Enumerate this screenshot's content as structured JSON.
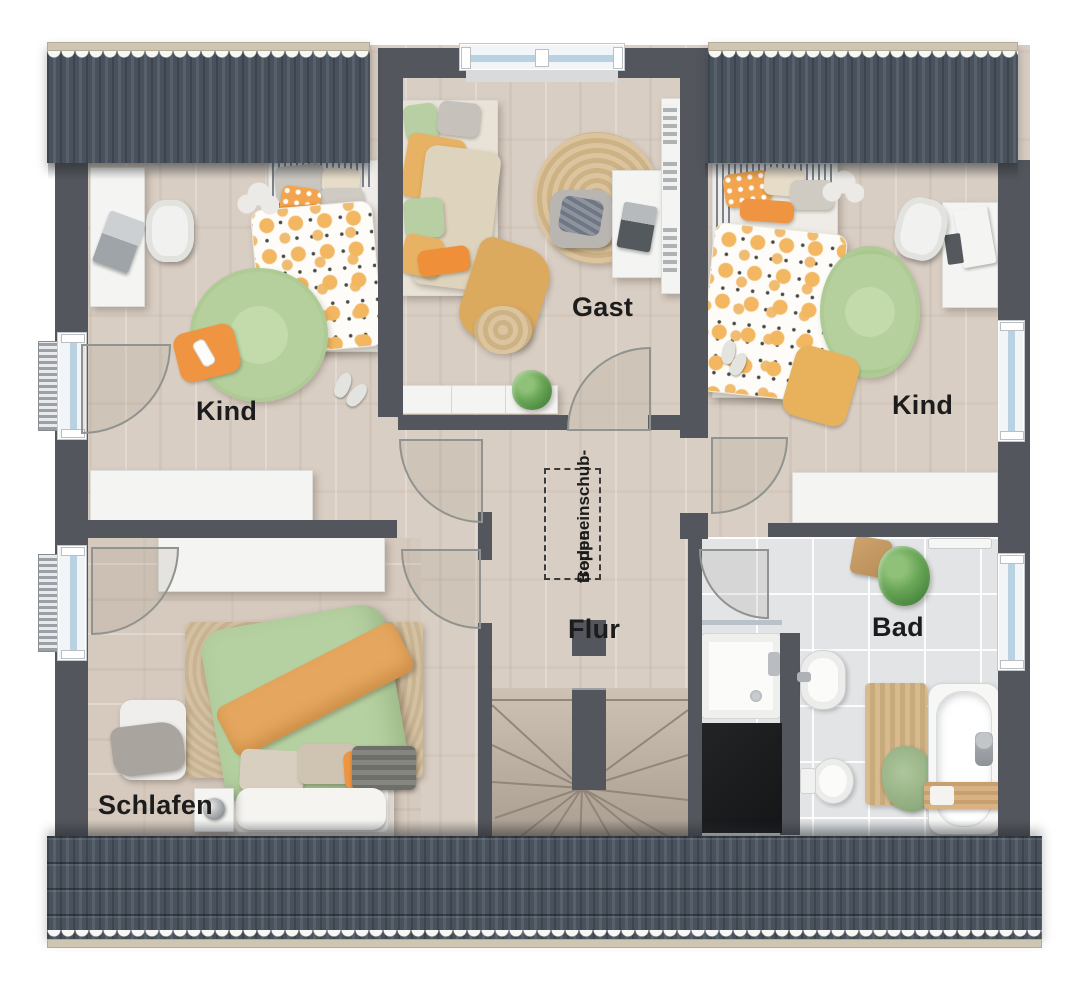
{
  "plan": {
    "kind": "attic-floor-plan"
  },
  "rooms": {
    "kind_left": {
      "label": "Kind"
    },
    "gast": {
      "label": "Gast"
    },
    "kind_right": {
      "label": "Kind"
    },
    "flur": {
      "label": "Flur"
    },
    "schlafen": {
      "label": "Schlafen"
    },
    "bad": {
      "label": "Bad"
    }
  },
  "annotations": {
    "attic_hatch_line1": "Bodeneinschub-",
    "attic_hatch_line2": "treppe"
  },
  "colors": {
    "wall": "#53565c",
    "roof": "#47505a",
    "wood_floor": "#d9cec3",
    "tile_floor": "#e2e4e6",
    "accent_orange": "#ef9440",
    "accent_green": "#b6d1a1",
    "accent_yellow": "#e8b25c",
    "furniture_white": "#f4f4f2"
  }
}
